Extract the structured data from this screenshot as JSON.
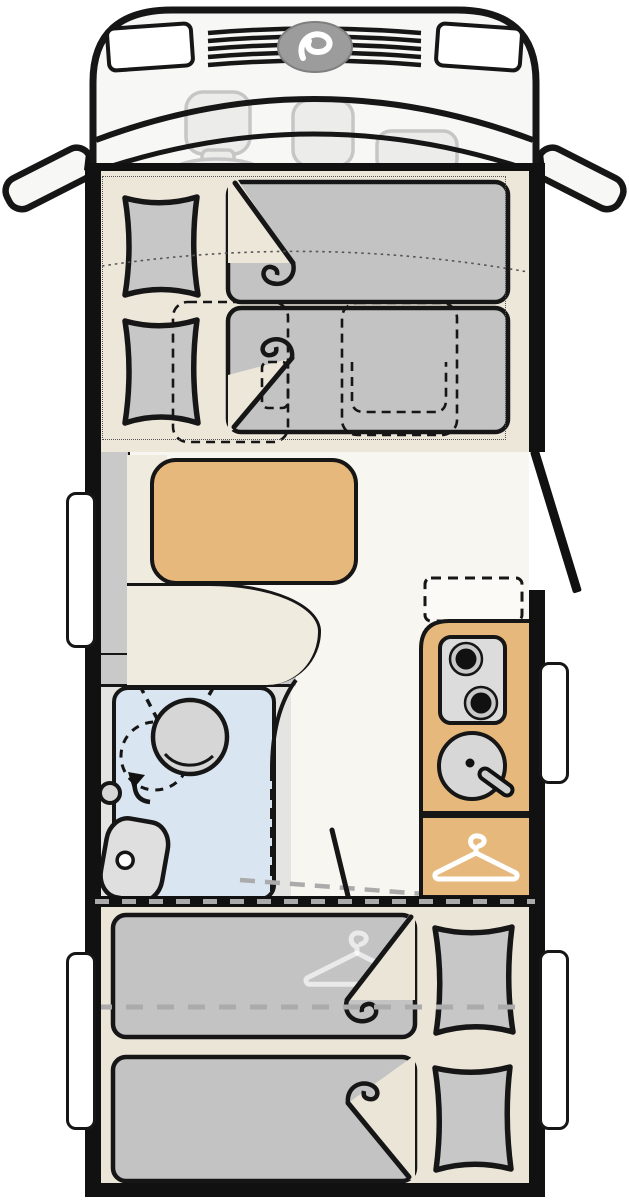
{
  "diagram_type": "motorhome-floor-plan",
  "colors": {
    "ink": "#161616",
    "wall": "#111111",
    "cab_fill": "#F7F7F6",
    "ghost_stroke": "#C6C6C6",
    "ghost_fill": "#ECECEB",
    "floor_front": "#EDE7DA",
    "floor_lounge": "#F8F6F0",
    "floor_rear": "#EBE5D8",
    "furniture_tan": "#E7B87C",
    "duvet_gray": "#C3C3C3",
    "pillow_gray": "#C7C7C7",
    "backrest_gray": "#C9C9C9",
    "seat_cream": "#F0EBDF",
    "shower_blue": "#D9E5F1",
    "bath_floor": "#E4E4E3",
    "fixture_gray": "#D6D6D6",
    "stove_gray": "#DCDCDC",
    "window_white": "#FFFFFF",
    "logo_gray": "#9C9C9C",
    "dash_gray": "#ABABAB"
  },
  "icons": [
    "brand-logo-icon",
    "clothes-hanger-icon",
    "clothes-hanger-watermark-icon",
    "swivel-arrow-icon",
    "stove-burner-icon",
    "sink-faucet-icon"
  ],
  "semantics": {
    "rooms": [
      {
        "name": "driver-cab",
        "fixtures": [
          "driver-seat",
          "steering-wheel",
          "passenger-seats",
          "side-mirrors",
          "grille",
          "headlights",
          "brand-logo"
        ]
      },
      {
        "name": "front-drop-down-beds",
        "fixtures": [
          "two-single-beds",
          "pillows",
          "duvets",
          "swivel-seat-outlines-dashed"
        ]
      },
      {
        "name": "lounge-dinette",
        "fixtures": [
          "l-shaped-bench",
          "backrest",
          "table"
        ]
      },
      {
        "name": "entry",
        "fixtures": [
          "entrance-door-open"
        ]
      },
      {
        "name": "bathroom",
        "fixtures": [
          "shower-tray",
          "swivel-washbasin",
          "toilet",
          "shower-screen-dashed",
          "door-swing-dashed"
        ]
      },
      {
        "name": "kitchen",
        "fixtures": [
          "worktop",
          "two-burner-stove",
          "round-sink",
          "faucet",
          "optional-unit-dashed"
        ]
      },
      {
        "name": "wardrobe",
        "fixtures": [
          "clothes-hanger-symbol"
        ]
      },
      {
        "name": "rear-bedroom",
        "fixtures": [
          "two-lengthwise-single-beds",
          "pillows",
          "duvets",
          "hanger-watermark",
          "conversion-dashed-line"
        ]
      }
    ],
    "windows": [
      "left-lounge",
      "left-rear",
      "right-kitchen",
      "right-rear"
    ]
  }
}
